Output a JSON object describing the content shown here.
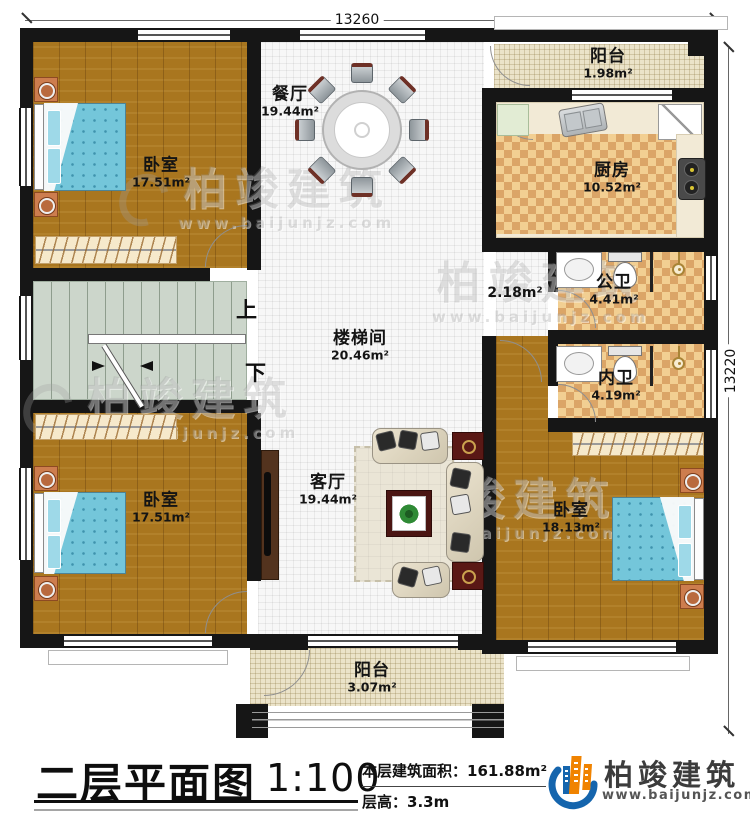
{
  "plan": {
    "dimensions": {
      "width_mm": "13260",
      "height_mm": "13220"
    },
    "rooms": {
      "bedroom_top_left": {
        "name": "卧室",
        "area": "17.51m²"
      },
      "dining": {
        "name": "餐厅",
        "area": "19.44m²"
      },
      "balcony_top": {
        "name": "阳台",
        "area": "1.98m²"
      },
      "kitchen": {
        "name": "厨房",
        "area": "10.52m²"
      },
      "hallway_area": {
        "area": "2.18m²"
      },
      "public_bath": {
        "name": "公卫",
        "area": "4.41m²"
      },
      "private_bath": {
        "name": "内卫",
        "area": "4.19m²"
      },
      "stair_hall": {
        "name": "楼梯间",
        "area": "20.46m²"
      },
      "bedroom_bottom_left": {
        "name": "卧室",
        "area": "17.51m²"
      },
      "living": {
        "name": "客厅",
        "area": "19.44m²"
      },
      "bedroom_bottom_right": {
        "name": "卧室",
        "area": "18.13m²"
      },
      "balcony_bottom": {
        "name": "阳台",
        "area": "3.07m²"
      }
    },
    "stairs": {
      "up_label": "上",
      "down_label": "下"
    }
  },
  "title_block": {
    "title": "二层平面图",
    "scale": "1:100",
    "floor_area_label": "本层建筑面积：",
    "floor_area_value": "161.88m²",
    "floor_height_label": "层高：",
    "floor_height_value": "3.3m"
  },
  "branding": {
    "company": "柏竣建筑",
    "website": "www.baijunjz.com"
  },
  "watermark": {
    "text": "柏竣建筑",
    "website": "www.baijunjz.com"
  },
  "colors": {
    "wall": "#161616",
    "wood_floor": "#a9761f",
    "tile_checker": "#dba567",
    "balcony_floor": "#ebe3c9",
    "stair_floor": "#ccd6cb",
    "bed_blue": "#74c6da",
    "logo_blue": "#1565ad",
    "logo_orange": "#f08300"
  }
}
